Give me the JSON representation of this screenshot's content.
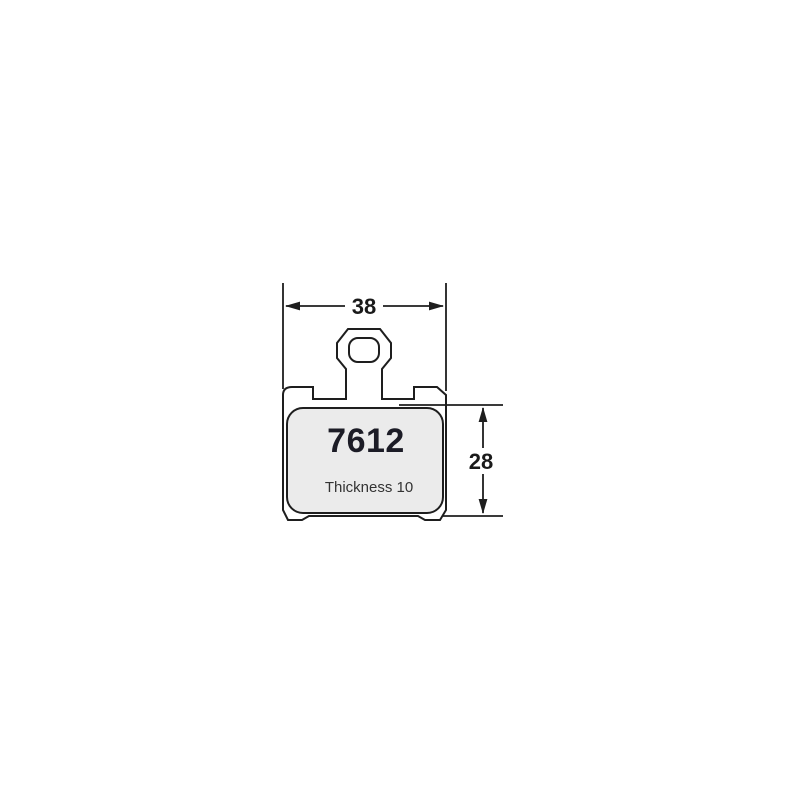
{
  "diagram": {
    "part_number": "7612",
    "thickness_label": "Thickness 10",
    "dimensions": {
      "width_mm": "38",
      "height_mm": "28"
    },
    "colors": {
      "outline": "#1e1e1e",
      "friction_fill": "#ebebeb",
      "label_text": "#1c1c26",
      "background": "#ffffff"
    }
  }
}
